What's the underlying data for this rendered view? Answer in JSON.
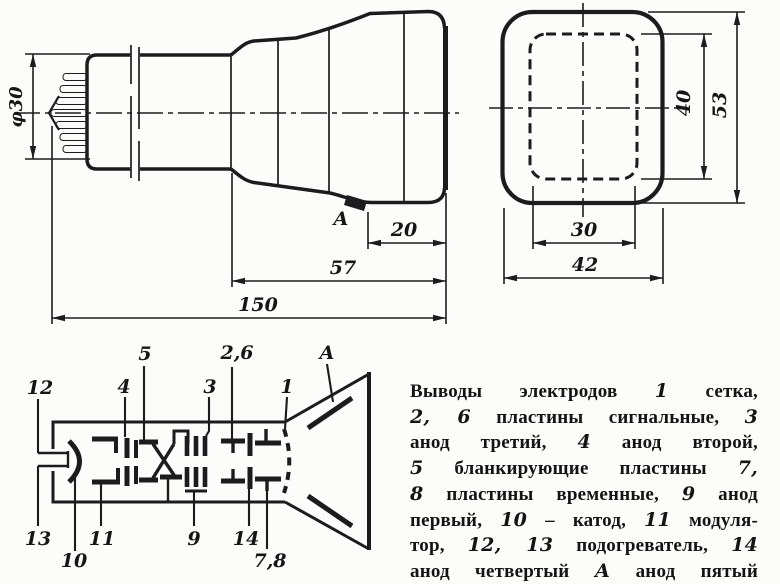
{
  "figure": {
    "side_view": {
      "dim_diameter": "φ30",
      "dim_20": "20",
      "dim_57": "57",
      "dim_150": "150",
      "anode_tab_label": "А"
    },
    "front_view": {
      "dim_inner_height": "40",
      "dim_outer_height": "53",
      "dim_inner_width": "30",
      "dim_outer_width": "42"
    },
    "electrode_diagram": {
      "top_labels": [
        "12",
        "4",
        "5",
        "3",
        "2,6",
        "1",
        "А"
      ],
      "bottom_labels": [
        "13",
        "10",
        "11",
        "9",
        "14",
        "7,8"
      ]
    }
  },
  "legend": {
    "lines": [
      "Выводы электродов *1* сетка,",
      "*2, 6* пластины сигнальные, *3*",
      "анод третий, *4* анод второй,",
      "*5* бланкирующие пластины *7,*",
      "*8* пластины временные, *9* анод",
      "первый, *10* – катод, *11* модуля-",
      "тор, *12, 13* подогреватель, *14*",
      "анод четвертый *А* анод пятый"
    ]
  },
  "colors": {
    "ink": "#1c1c1e",
    "paper": "#fcfcfa"
  }
}
